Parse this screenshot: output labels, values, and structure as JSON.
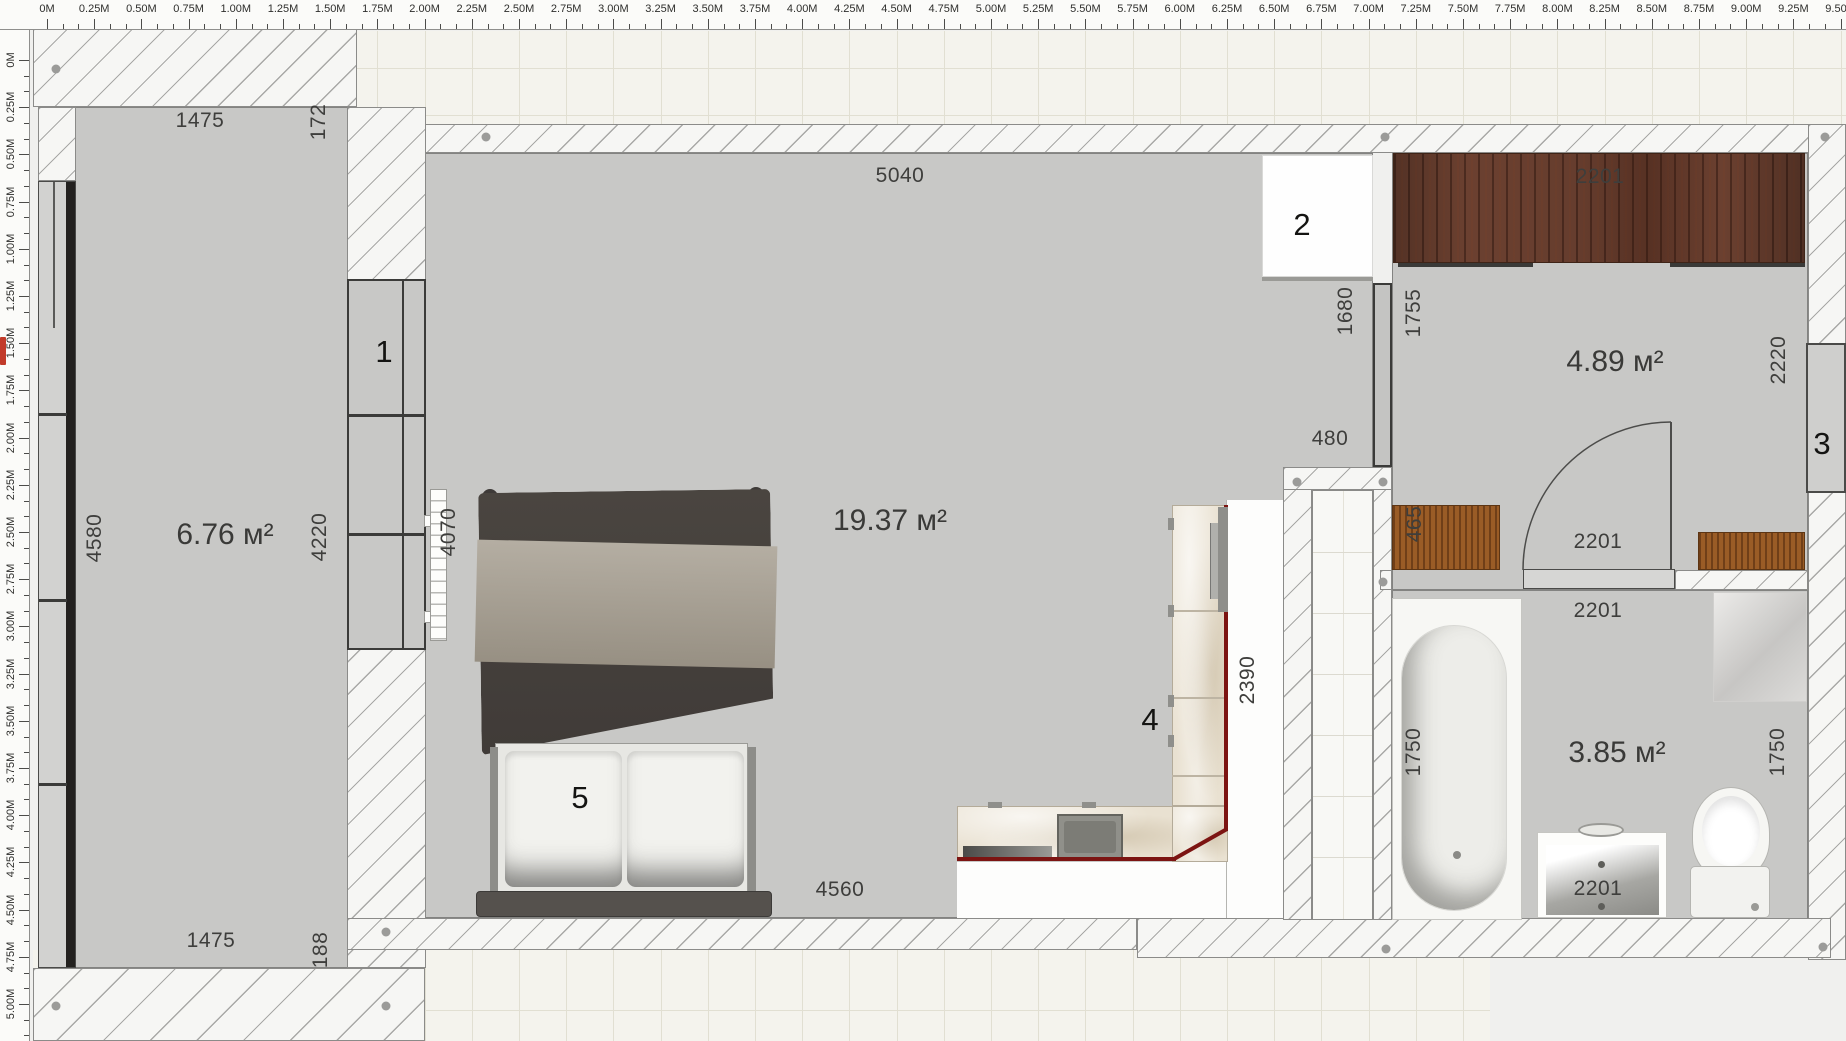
{
  "colors": {
    "accent_red": "#7c1412",
    "wood_dark": "#6b4030",
    "wood_light": "#9a5c26",
    "floor": "#c8c8c6",
    "wall_line": "#a8a8a6"
  },
  "rulers": {
    "unit_suffix": "M",
    "top_labels": [
      "0M",
      "0.25M",
      "0.50M",
      "0.75M",
      "1.00M",
      "1.25M",
      "1.50M",
      "1.75M",
      "2.00M",
      "2.25M",
      "2.50M",
      "2.75M",
      "3.00M",
      "3.25M",
      "3.50M",
      "3.75M",
      "4.00M",
      "4.25M",
      "4.50M",
      "4.75M",
      "5.00M",
      "5.25M",
      "5.50M",
      "5.75M",
      "6.00M",
      "6.25M",
      "6.50M",
      "6.75M",
      "7.00M",
      "7.25M",
      "7.50M",
      "7.75M",
      "8.00M",
      "8.25M",
      "8.50M",
      "8.75M",
      "9.00M",
      "9.25M",
      "9.50M"
    ],
    "left_labels": [
      "0M",
      "0.25M",
      "0.50M",
      "0.75M",
      "1.00M",
      "1.25M",
      "1.50M",
      "1.75M",
      "2.00M",
      "2.25M",
      "2.50M",
      "2.75M",
      "3.00M",
      "3.25M",
      "3.50M",
      "3.75M",
      "4.00M",
      "4.25M",
      "4.50M",
      "4.75M",
      "5.00M"
    ]
  },
  "areas": [
    {
      "text": "6.76 м²",
      "x": 225,
      "y": 535
    },
    {
      "text": "19.37 м²",
      "x": 890,
      "y": 521
    },
    {
      "text": "4.89 м²",
      "x": 1615,
      "y": 362
    },
    {
      "text": "3.85 м²",
      "x": 1617,
      "y": 753
    }
  ],
  "dimensions": [
    {
      "text": "1475",
      "x": 200,
      "y": 121
    },
    {
      "text": "172",
      "x": 319,
      "y": 122,
      "rot": true
    },
    {
      "text": "5040",
      "x": 900,
      "y": 176
    },
    {
      "text": "2201",
      "x": 1600,
      "y": 177
    },
    {
      "text": "1680",
      "x": 1346,
      "y": 311,
      "rot": true
    },
    {
      "text": "1755",
      "x": 1414,
      "y": 313,
      "rot": true
    },
    {
      "text": "2220",
      "x": 1779,
      "y": 360,
      "rot": true
    },
    {
      "text": "480",
      "x": 1330,
      "y": 439
    },
    {
      "text": "465",
      "x": 1415,
      "y": 524,
      "rot": true
    },
    {
      "text": "4580",
      "x": 95,
      "y": 538,
      "rot": true
    },
    {
      "text": "4220",
      "x": 320,
      "y": 537,
      "rot": true
    },
    {
      "text": "4070",
      "x": 449,
      "y": 532,
      "rot": true
    },
    {
      "text": "2201",
      "x": 1598,
      "y": 542
    },
    {
      "text": "2201",
      "x": 1598,
      "y": 611
    },
    {
      "text": "2390",
      "x": 1248,
      "y": 680,
      "rot": true
    },
    {
      "text": "1750",
      "x": 1414,
      "y": 752,
      "rot": true
    },
    {
      "text": "1750",
      "x": 1778,
      "y": 752,
      "rot": true
    },
    {
      "text": "2201",
      "x": 1598,
      "y": 889
    },
    {
      "text": "4560",
      "x": 840,
      "y": 890
    },
    {
      "text": "1475",
      "x": 211,
      "y": 941
    },
    {
      "text": "188",
      "x": 321,
      "y": 950,
      "rot": true
    }
  ],
  "markers": [
    {
      "text": "1",
      "x": 384,
      "y": 352
    },
    {
      "text": "2",
      "x": 1302,
      "y": 225
    },
    {
      "text": "3",
      "x": 1822,
      "y": 444
    },
    {
      "text": "4",
      "x": 1150,
      "y": 720
    },
    {
      "text": "5",
      "x": 580,
      "y": 798
    }
  ],
  "pins": [
    {
      "x": 56,
      "y": 69
    },
    {
      "x": 486,
      "y": 137
    },
    {
      "x": 1385,
      "y": 137
    },
    {
      "x": 1825,
      "y": 137
    },
    {
      "x": 1297,
      "y": 482
    },
    {
      "x": 1383,
      "y": 482
    },
    {
      "x": 1383,
      "y": 582
    },
    {
      "x": 386,
      "y": 932
    },
    {
      "x": 56,
      "y": 1006
    },
    {
      "x": 386,
      "y": 1006
    },
    {
      "x": 1386,
      "y": 949
    },
    {
      "x": 1823,
      "y": 947
    }
  ]
}
